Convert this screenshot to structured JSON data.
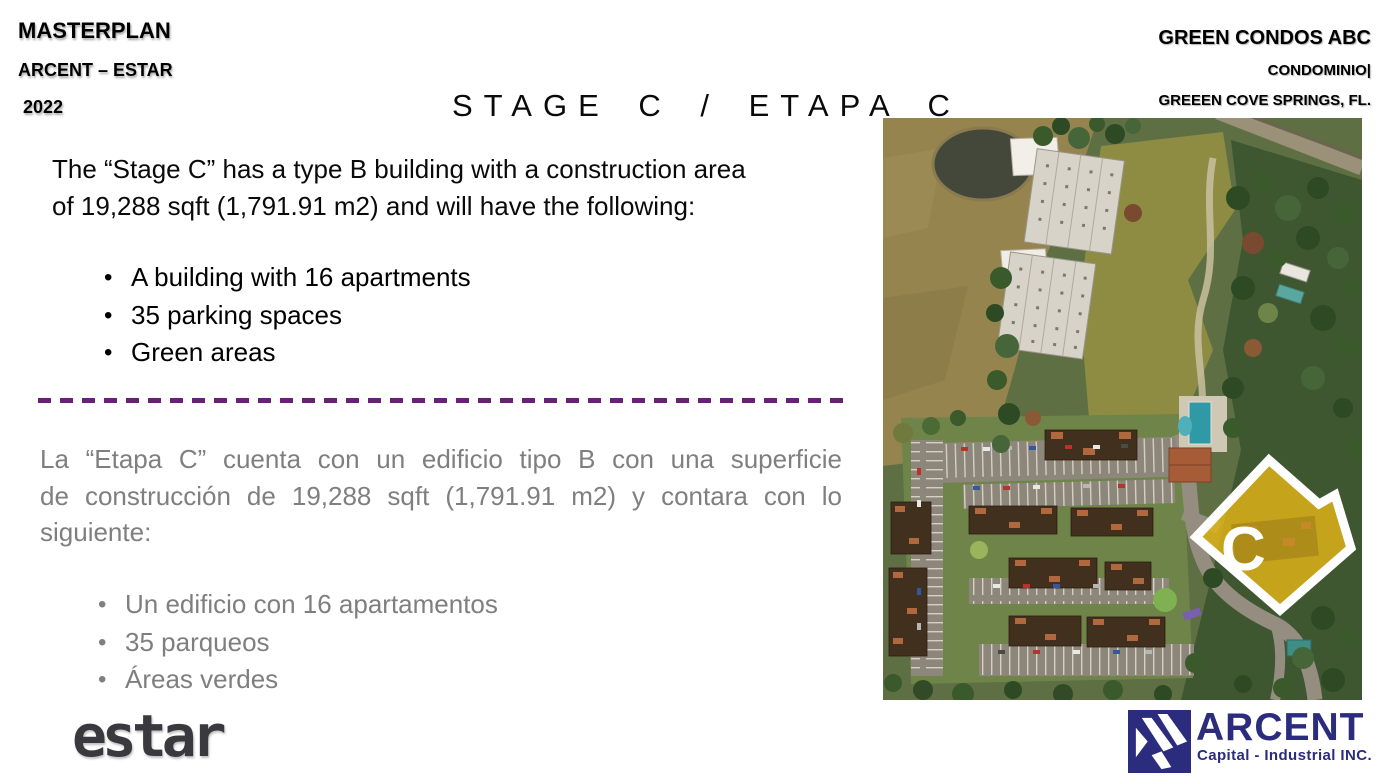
{
  "header_left": {
    "title": "MASTERPLAN",
    "subtitle": "ARCENT – ESTAR",
    "year": "2022"
  },
  "header_right": {
    "project": "GREEN CONDOS ABC",
    "type": "CONDOMINIO|",
    "location": "GREEEN COVE SPRINGS, FL."
  },
  "title": "STAGE C / ETAPA C",
  "english": {
    "lines": [
      "The “Stage C” has a type B building with a construction area",
      "of 19,288 sqft (1,791.91 m2) and will have the following:"
    ],
    "bullets": [
      "A building with 16 apartments",
      "35 parking spaces",
      "Green areas"
    ]
  },
  "spanish": {
    "lines": [
      "La “Etapa C” cuenta con un edificio tipo B con una superficie",
      "de construcción de 19,288 sqft (1,791.91 m2) y contara con lo",
      "siguiente:"
    ],
    "bullets": [
      "Un edificio con 16 apartamentos",
      "35 parqueos",
      "Áreas verdes"
    ]
  },
  "site_plan": {
    "stage_label": "C"
  },
  "footer": {
    "estar_logo_text": "estar",
    "arcent_logo_text": "ARCENT",
    "arcent_subtitle": "Capital - Industrial INC."
  },
  "colors": {
    "divider_purple": "#6B2077",
    "secondary_text_gray": "#7F7F7F",
    "arcent_navy": "#2B2C7D",
    "stage_highlight_yellow": "#E3B516",
    "estar_charcoal": "#3A393E"
  }
}
